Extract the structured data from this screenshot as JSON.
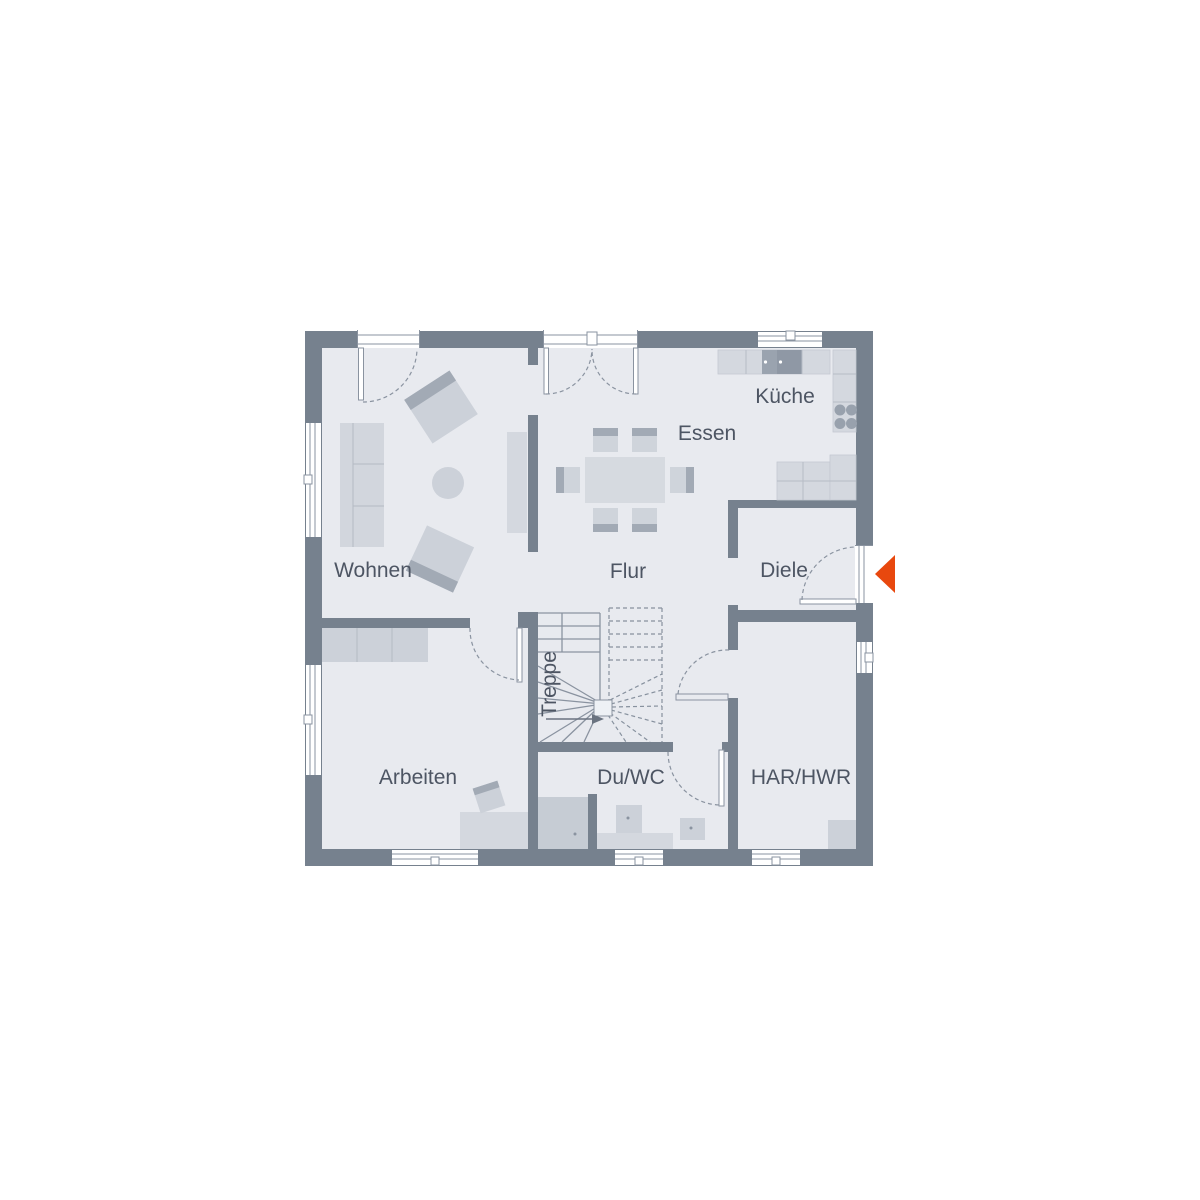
{
  "floorplan": {
    "title": "ground-floor-plan",
    "labels": {
      "wohnen": "Wohnen",
      "essen": "Essen",
      "kueche": "Küche",
      "flur": "Flur",
      "diele": "Diele",
      "treppe": "Treppe",
      "arbeiten": "Arbeiten",
      "duwc": "Du/WC",
      "harhwr": "HAR/HWR"
    },
    "colors": {
      "wall": "#76818e",
      "floor": "#e8eaef",
      "furniture_light": "#d2d6dd",
      "furniture_mid": "#ccd1d9",
      "furniture_accent": "#a2aab5",
      "appliance_dark": "#8f98a5",
      "outline": "#8a93a0",
      "label_text": "#4d5563",
      "entrance_arrow": "#e8480e"
    },
    "icons": {
      "entrance_arrow": "left-pointing-triangle"
    }
  }
}
